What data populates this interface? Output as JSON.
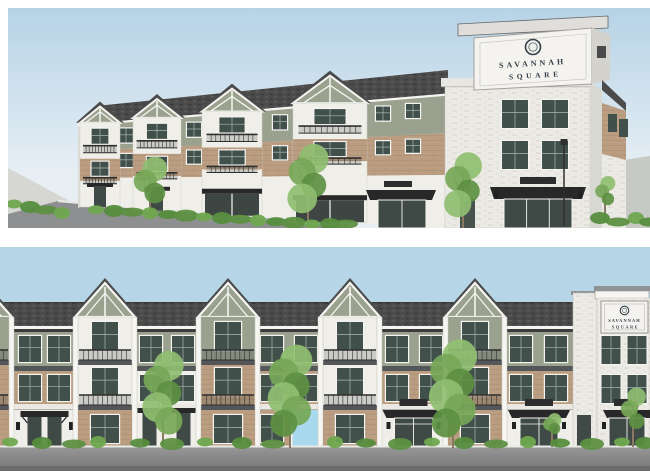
{
  "sign": {
    "line1": "SAVANNAH",
    "line2": "SQUARE"
  },
  "colors": {
    "skyTop": "#b6d3e6",
    "skyLow": "#e7eff5",
    "skyFlat": "#b6d6e8",
    "roof": "#4b4b4b",
    "roofDark": "#383838",
    "roofLight": "#5e5e5e",
    "sage": "#9aa18e",
    "brick": "#bb9e81",
    "brickLine": "#ad9174",
    "whiteWall": "#efeee9",
    "whiteBrick": "#eceae5",
    "whiteBrickShade": "#e1dfd8",
    "trim": "#f6f5f1",
    "shadedFace": "#d8d8d3",
    "glass": "#42504b",
    "mullion": "#a9b8b2",
    "darkBand": "#54575a",
    "railing": "#2e2e2e",
    "awning": "#282828",
    "plaque": "#2d2d2d",
    "signBg": "#f4f3ef",
    "signText": "#333f49",
    "signBorder": "#98968f",
    "pavement": "#919191",
    "road": "#8e8f90",
    "curb": "#e9e9e5",
    "groundRight": "#c7c9c5",
    "sidewalkFar": "#d6d7d2",
    "foliage": "#76a757",
    "foliageLight": "#8fbe71",
    "foliageDark": "#5d9042",
    "shrub": "#568d3d",
    "shrubLight": "#6fa84f",
    "trunk": "#8a7a63",
    "breezeway": "#a9d9ee",
    "doorDark": "#3f4a46"
  },
  "top_view": {
    "label": "perspective rendering",
    "facade": {
      "x0": 77,
      "x1": 440,
      "eave0": 115,
      "eave1": 84,
      "brickTop0": 143,
      "brickTop1": 125,
      "white0": 170,
      "white1": 167,
      "base0": 197,
      "base1": 221
    },
    "gable_bays": [
      {
        "cx": 92,
        "hw": 20
      },
      {
        "cx": 149,
        "hw": 24
      },
      {
        "cx": 224,
        "hw": 30
      },
      {
        "cx": 322,
        "hw": 37
      }
    ],
    "gap_windows": [
      118,
      186,
      272,
      375,
      405
    ],
    "tower": {
      "window_cols": [
        507,
        547
      ],
      "window_rows": [
        92,
        133
      ]
    },
    "trees": [
      {
        "cx": 142,
        "fy": 152,
        "by": 210,
        "r": 20
      },
      {
        "cx": 300,
        "fy": 140,
        "by": 216,
        "r": 24
      },
      {
        "cx": 455,
        "fy": 148,
        "by": 221,
        "r": 22
      },
      {
        "cx": 597,
        "fy": 170,
        "by": 213,
        "r": 12
      }
    ],
    "shrub_xs": [
      88,
      106,
      124,
      142,
      160,
      178,
      196,
      214,
      232,
      250,
      268,
      286,
      304,
      322,
      338
    ],
    "left_shrub_xs": [
      6,
      22,
      38,
      54
    ],
    "right_shrub_xs": [
      592,
      610,
      628,
      641
    ]
  },
  "bottom_view": {
    "label": "street elevation rendering",
    "bays": [
      {
        "cx": -18,
        "variant": "B"
      },
      {
        "cx": 105,
        "variant": "A"
      },
      {
        "cx": 228,
        "variant": "B"
      },
      {
        "cx": 350,
        "variant": "A"
      },
      {
        "cx": 475,
        "variant": "B"
      }
    ],
    "sections": [
      {
        "x0": 14,
        "x1": 75,
        "second": "brick",
        "windows": [
          30,
          59
        ],
        "entry": "porch"
      },
      {
        "x0": 135,
        "x1": 198,
        "second": "white",
        "windows": [
          151,
          183
        ],
        "entry": "twin-doors"
      },
      {
        "x0": 258,
        "x1": 320,
        "second": "brick",
        "windows": [
          272,
          306
        ],
        "entry": "brick-breezeway"
      },
      {
        "x0": 382,
        "x1": 445,
        "second": "brick",
        "windows": [
          397,
          431
        ],
        "entry": "awning-entry"
      },
      {
        "x0": 505,
        "x1": 573,
        "second": "brick",
        "windows": [
          521,
          556
        ],
        "entry": "awning-entry"
      }
    ],
    "tower": {
      "windows": [
        611,
        637
      ],
      "entry_mid": 626
    },
    "trees": [
      {
        "cx": 163,
        "fy": 108,
        "by": 200,
        "r": 24
      },
      {
        "cx": 290,
        "fy": 102,
        "by": 201,
        "r": 26
      },
      {
        "cx": 453,
        "fy": 97,
        "by": 201,
        "r": 28
      },
      {
        "cx": 552,
        "fy": 168,
        "by": 200,
        "r": 11
      },
      {
        "cx": 633,
        "fy": 143,
        "by": 200,
        "r": 15
      }
    ],
    "shrub_xs": [
      10,
      42,
      74,
      98,
      140,
      172,
      205,
      242,
      273,
      335,
      366,
      400,
      432,
      464,
      496,
      528,
      560,
      592,
      622,
      645
    ]
  }
}
